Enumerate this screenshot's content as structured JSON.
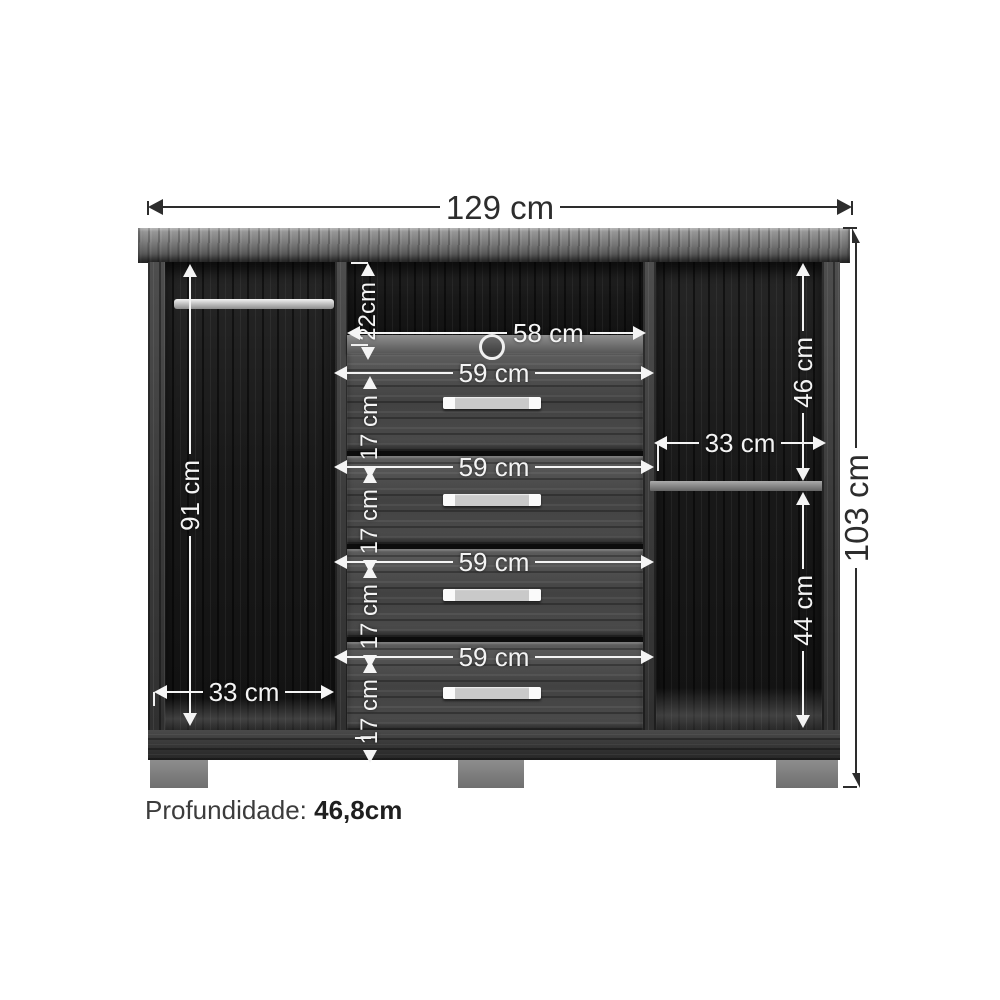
{
  "diagram": {
    "type": "furniture-dimension-diagram",
    "dims": {
      "total_width": "129 cm",
      "total_height": "103 cm",
      "left_inner_height": "91 cm",
      "left_bottom_width": "33 cm",
      "niche_height": "22cm",
      "niche_width": "58 cm",
      "right_top_height": "46 cm",
      "right_inner_width": "33 cm",
      "right_bottom_height": "44 cm",
      "drawers": [
        {
          "width": "59 cm",
          "gap": "17 cm"
        },
        {
          "width": "59 cm",
          "gap": "17 cm"
        },
        {
          "width": "59 cm",
          "gap": "17 cm"
        },
        {
          "width": "59 cm",
          "gap": "17 cm"
        }
      ]
    },
    "note": {
      "label": "Profundidade:",
      "value": "46,8cm"
    },
    "colors": {
      "background": "#ffffff",
      "annotation_light": "#f4f4f4",
      "annotation_dark": "#2d2d2d",
      "wood_dark": "#3a3a3a",
      "wood_interior": "#1a1a1a",
      "feet_gray": "#7d7d7d"
    }
  }
}
